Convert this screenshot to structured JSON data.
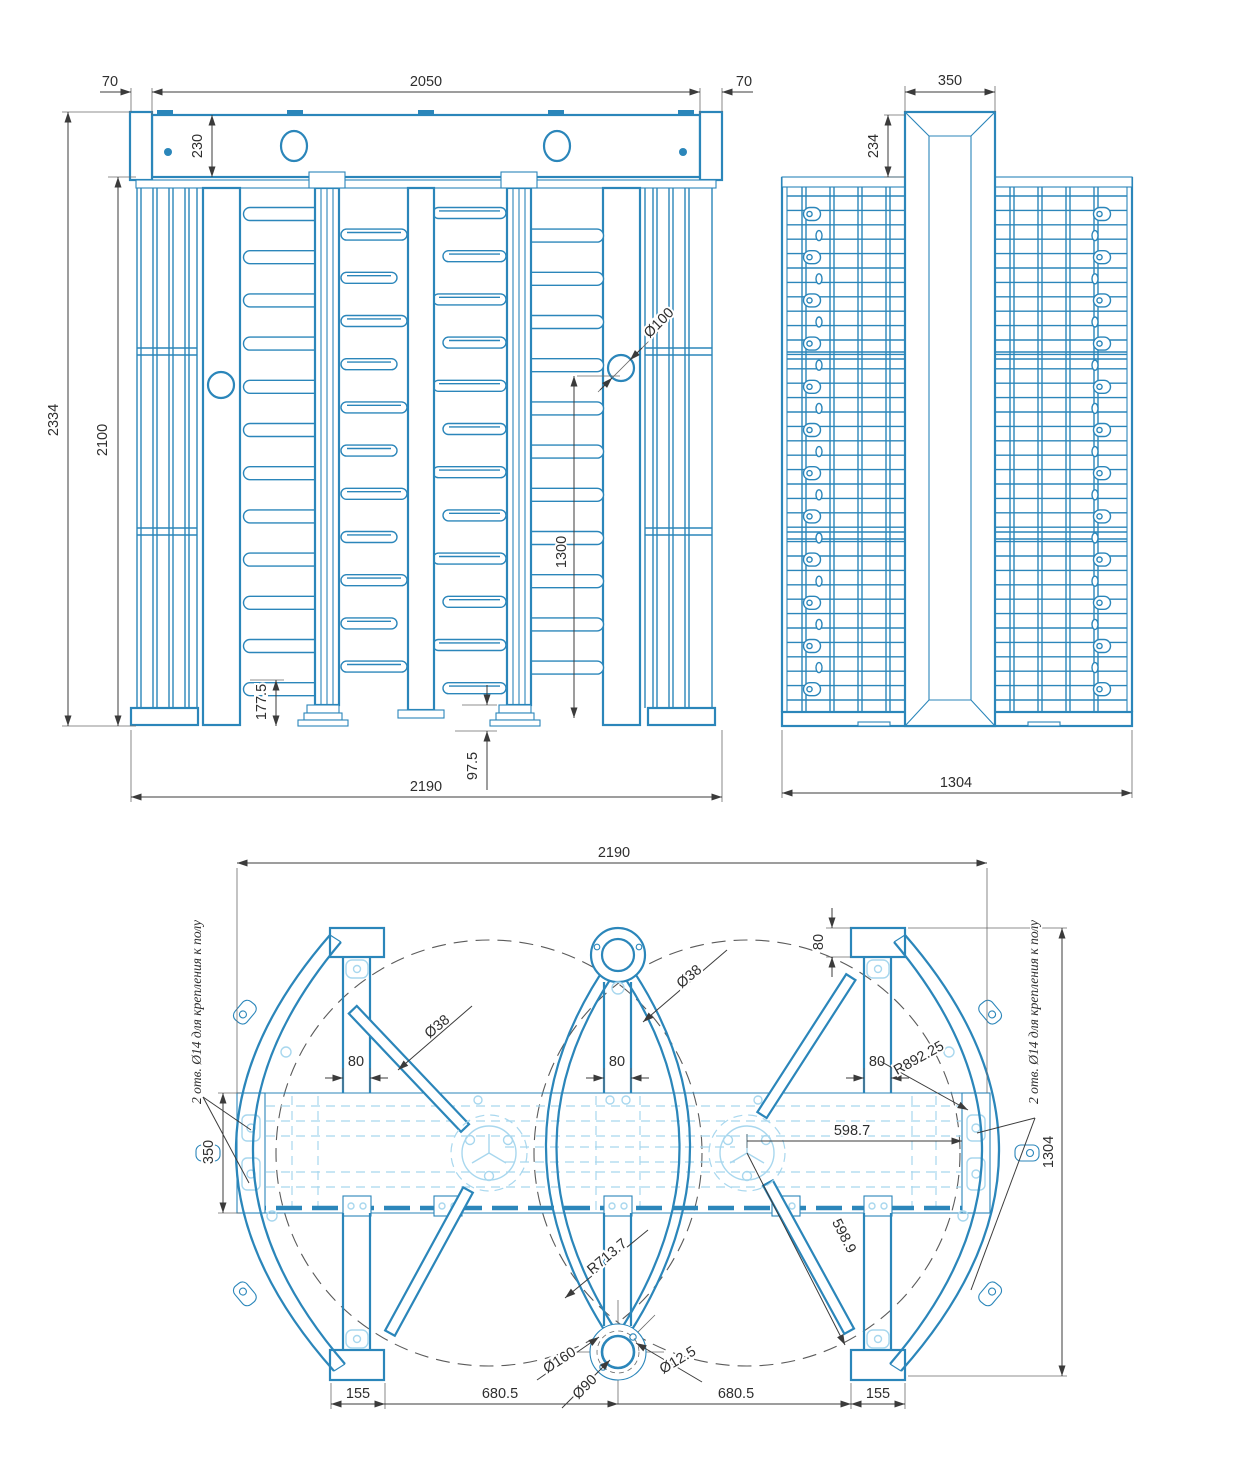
{
  "drawing_type": "turnstile-full-height-double-technical-drawing",
  "colors": {
    "line": "#2b86ba",
    "light_line": "#a8d7ee",
    "dim_line": "#3b3b3b"
  },
  "front_view": {
    "dims": {
      "left_margin": "70",
      "header_width": "2050",
      "right_margin": "70",
      "header_height": "230",
      "overall_height": "2334",
      "frame_height": "2100",
      "hole_dia": "Ø100",
      "bar_span": "1300",
      "arm_clearance": "177.5",
      "base_height": "97.5",
      "overall_width": "2190"
    }
  },
  "side_view": {
    "dims": {
      "column_width": "350",
      "column_top_offset": "234",
      "overall_depth": "1304"
    }
  },
  "plan_view": {
    "dims": {
      "overall_width": "2190",
      "plate_height": "80",
      "post_left": "80",
      "post_center": "80",
      "post_right": "80",
      "arm_dia_left": "Ø38",
      "arm_dia_center": "Ø38",
      "guide_radius": "R892.25",
      "beam_depth": "350",
      "hub_to_plate": "598.7",
      "hub_to_flange": "598.9",
      "rotor_radius": "R713.7",
      "flange_dia": "Ø160",
      "pipe_dia": "Ø90",
      "bolt_hole_dia": "Ø12.5",
      "foot_left": "155",
      "span_left": "680.5",
      "span_right": "680.5",
      "foot_right": "155",
      "overall_depth": "1304"
    },
    "notes": {
      "anchor_left": "2 отв. Ø14 для крепления к полу",
      "anchor_right": "2 отв. Ø14 для крепления к полу"
    }
  }
}
